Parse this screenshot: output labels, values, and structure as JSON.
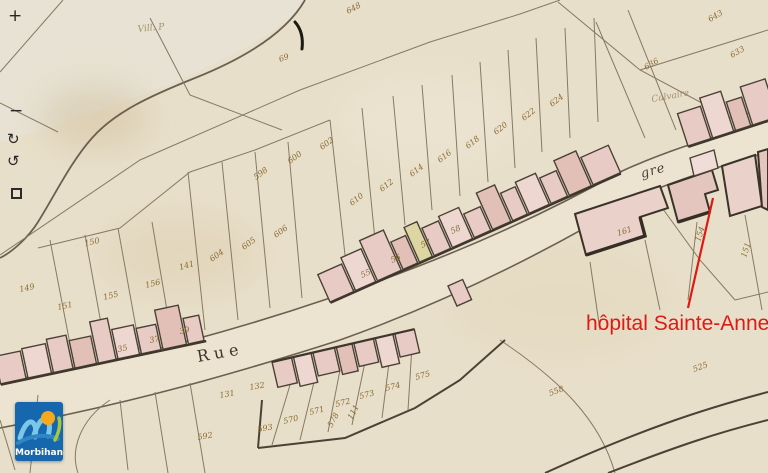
{
  "controls": {
    "zoom_in": "+",
    "zoom_out": "−",
    "rotate_cw": "↻",
    "rotate_ccw": "↺",
    "extent_icon": "dashed-square"
  },
  "logo": {
    "text": "Morbihan",
    "colors": {
      "bg": "#1767ae",
      "wave_light": "#7cc6e8",
      "wave_mid": "#2e86c4",
      "sun": "#f7a81b",
      "leaf": "#a5c93c",
      "text": "#ffffff"
    }
  },
  "annotation": {
    "label": "hôpital Sainte-Anne",
    "color": "#e01912"
  },
  "map_labels": {
    "street_left": "Rue",
    "street_right": "gre",
    "hamlet": "Vill. P",
    "faint": "Calvaire"
  },
  "palette": {
    "paper": "#e8dfca",
    "street": "#ece4d0",
    "building_pink": "#e7cbc4",
    "building_yellow": "#ddd6a3",
    "line_thin": "#857a63",
    "line_heavy": "#3f372b",
    "number_ink": "#8a6a33"
  },
  "parcel_numbers": [
    {
      "v": "149",
      "x": 20,
      "y": 292,
      "r": -12
    },
    {
      "v": "151",
      "x": 58,
      "y": 310,
      "r": -12
    },
    {
      "v": "150",
      "x": 85,
      "y": 246,
      "r": -12
    },
    {
      "v": "155",
      "x": 104,
      "y": 300,
      "r": -14
    },
    {
      "v": "156",
      "x": 146,
      "y": 288,
      "r": -14
    },
    {
      "v": "141",
      "x": 180,
      "y": 270,
      "r": -16
    },
    {
      "v": "35",
      "x": 118,
      "y": 352,
      "r": -12,
      "s": 6
    },
    {
      "v": "37",
      "x": 150,
      "y": 343,
      "r": -12,
      "s": 6
    },
    {
      "v": "39",
      "x": 180,
      "y": 334,
      "r": -12,
      "s": 6
    },
    {
      "v": "131",
      "x": 220,
      "y": 398,
      "r": -10,
      "s": 7
    },
    {
      "v": "132",
      "x": 250,
      "y": 390,
      "r": -10,
      "s": 7
    },
    {
      "v": "598",
      "x": 256,
      "y": 180,
      "r": -36
    },
    {
      "v": "600",
      "x": 290,
      "y": 164,
      "r": -36
    },
    {
      "v": "602",
      "x": 322,
      "y": 150,
      "r": -36
    },
    {
      "v": "604",
      "x": 212,
      "y": 262,
      "r": -36
    },
    {
      "v": "605",
      "x": 244,
      "y": 250,
      "r": -36
    },
    {
      "v": "606",
      "x": 276,
      "y": 238,
      "r": -36
    },
    {
      "v": "610",
      "x": 352,
      "y": 206,
      "r": -38
    },
    {
      "v": "612",
      "x": 382,
      "y": 192,
      "r": -38
    },
    {
      "v": "614",
      "x": 412,
      "y": 177,
      "r": -38
    },
    {
      "v": "616",
      "x": 440,
      "y": 163,
      "r": -38
    },
    {
      "v": "618",
      "x": 468,
      "y": 149,
      "r": -38
    },
    {
      "v": "620",
      "x": 496,
      "y": 135,
      "r": -38
    },
    {
      "v": "622",
      "x": 524,
      "y": 121,
      "r": -38
    },
    {
      "v": "624",
      "x": 552,
      "y": 107,
      "r": -38
    },
    {
      "v": "55",
      "x": 362,
      "y": 278,
      "r": -24,
      "s": 6
    },
    {
      "v": "56",
      "x": 392,
      "y": 263,
      "r": -24,
      "s": 6
    },
    {
      "v": "57",
      "x": 422,
      "y": 248,
      "r": -24,
      "s": 6
    },
    {
      "v": "58",
      "x": 452,
      "y": 234,
      "r": -24,
      "s": 6
    },
    {
      "v": "69",
      "x": 280,
      "y": 62,
      "r": -20
    },
    {
      "v": "648",
      "x": 348,
      "y": 14,
      "r": -28
    },
    {
      "v": "636",
      "x": 646,
      "y": 70,
      "r": -30
    },
    {
      "v": "643",
      "x": 710,
      "y": 22,
      "r": -30
    },
    {
      "v": "633",
      "x": 732,
      "y": 58,
      "r": -30
    },
    {
      "v": "570",
      "x": 284,
      "y": 424,
      "r": -14
    },
    {
      "v": "571",
      "x": 310,
      "y": 415,
      "r": -14
    },
    {
      "v": "572",
      "x": 336,
      "y": 407,
      "r": -14
    },
    {
      "v": "573",
      "x": 360,
      "y": 399,
      "r": -14
    },
    {
      "v": "574",
      "x": 386,
      "y": 391,
      "r": -14
    },
    {
      "v": "575",
      "x": 416,
      "y": 380,
      "r": -16
    },
    {
      "v": "592",
      "x": 198,
      "y": 440,
      "r": -10
    },
    {
      "v": "593",
      "x": 258,
      "y": 432,
      "r": -10
    },
    {
      "v": "578",
      "x": 332,
      "y": 428,
      "r": -62,
      "s": 7
    },
    {
      "v": "111",
      "x": 352,
      "y": 420,
      "r": -62,
      "s": 7
    },
    {
      "v": "558",
      "x": 550,
      "y": 396,
      "r": -20
    },
    {
      "v": "525",
      "x": 694,
      "y": 372,
      "r": -20
    },
    {
      "v": "151",
      "x": 746,
      "y": 258,
      "r": -72
    },
    {
      "v": "154",
      "x": 700,
      "y": 242,
      "r": -72,
      "s": 7
    },
    {
      "v": "161",
      "x": 618,
      "y": 236,
      "r": -18,
      "s": 7
    }
  ]
}
